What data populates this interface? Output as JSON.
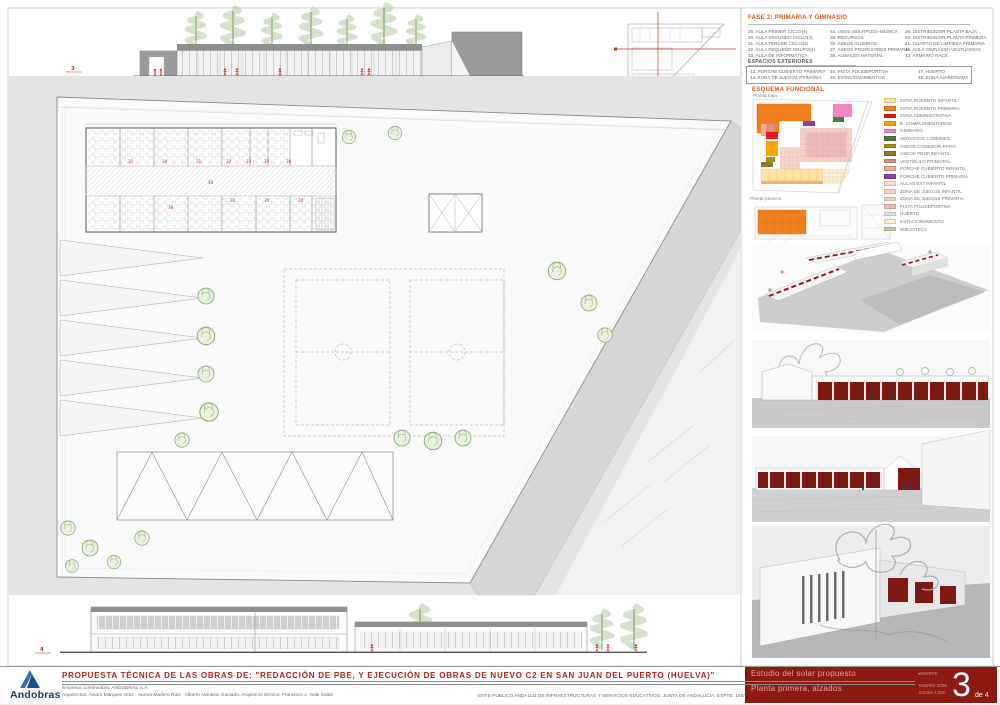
{
  "accent": {
    "orange_header": "#e2561c",
    "title_red": "#b3231a",
    "panel_dark_red": "#8b1a12",
    "figure_red": "#c0392b",
    "tree_green": "#85a468",
    "logo_blue": "#2f6db5",
    "logo_navy": "#1d4e8f"
  },
  "fase2": {
    "title": "FASE 2:   PRIMARIA Y GIMNASIO",
    "col1": [
      "29. AULA PRIMER CICLO(4)",
      "30. AULA SEGUNDO CICLO(4)",
      "31. AULA TERCER CICLO(4)",
      "32. AULA PEQUEÑO GRUPO(4)",
      "33. AULA DE INFORMÁTICA"
    ],
    "col2": [
      "34. USOS MÚLTIPLES+MÚSICA",
      "35. RECURSOS",
      "36. ASEOS ALUMNOS",
      "37. ASEOS PROFESORES PRIMARIA",
      "38. ALMACÉN MATERIAL"
    ],
    "col3": [
      "39. DISTRIBUIDOR PLANTA BAJA",
      "40. DISTRIBUIDOR PLANTA PRIMERA",
      "41. CUARTO DE LIMPIEZA PRIMARIA",
      "42. AULA GIMNASIO+VESTUARIOS",
      "43. ARMARIO RACK"
    ]
  },
  "exteriores": {
    "title": "ESPACIOS EXTERIORES",
    "col1": [
      "43. PORCHE CUBIERTO PRIMARIA",
      "44. ZONA DE JUEGOS PRIMARIA"
    ],
    "col2": [
      "45. PISTA POLIDEPORTIVA",
      "46. ESTACIONAMIENTOS"
    ],
    "col3": [
      "47. HUERTO",
      "48. ZONA AJARDINADA"
    ]
  },
  "esquema": {
    "title": "ESQUEMA FUNCIONAL",
    "planta_baja": "Planta baja",
    "planta_primera": "Planta primera"
  },
  "legend": {
    "items": [
      {
        "label": "ZONA DOCENTE INFANTIL",
        "color": "#fbe3a3"
      },
      {
        "label": "ZONA DOCENTE PRIMARIA",
        "color": "#f07f1e"
      },
      {
        "label": "ZONA ADMINISTRATIVA",
        "color": "#e51717"
      },
      {
        "label": "E. COMPLEMENTARIOS",
        "color": "#f6a800"
      },
      {
        "label": "GIMNASIO",
        "color": "#f287c3"
      },
      {
        "label": "SERVICIOS COMUNES",
        "color": "#4d7b3c"
      },
      {
        "label": "ASEOS COMEDOR-PATIO",
        "color": "#a39312"
      },
      {
        "label": "ASEOS PROF.INFANTIL",
        "color": "#877d22"
      },
      {
        "label": "VESTÍBULO PRINCIPAL",
        "color": "#dd9180"
      },
      {
        "label": "PORCHE CUBIERTO INFANTIL",
        "color": "#f4a98b"
      },
      {
        "label": "PORCHE CUBIERTO PRIMARIA",
        "color": "#8e3f9e"
      },
      {
        "label": "AULAS EXT.INFANTIL",
        "color": "#f6dcd4"
      },
      {
        "label": "ZONA DE JUEGOS INFANTIL",
        "color": "#f4d3cb"
      },
      {
        "label": "ZONA DE JUEGOS PRIMARIA",
        "color": "#f2cfc7"
      },
      {
        "label": "PISTA POLIDEPORTIVA",
        "color": "#eeb9bb"
      },
      {
        "label": "HUERTO",
        "color": "#d9ead0"
      },
      {
        "label": "ESTACIONAMIENTO",
        "color": "#f6efd2"
      },
      {
        "label": "BIBLIOTECA",
        "color": "#c2cda6"
      }
    ]
  },
  "plan": {
    "marker_top": "3",
    "marker_bottom": "4",
    "room_numbers": [
      "31",
      "30",
      "31",
      "32",
      "33",
      "35",
      "36",
      "40",
      "38",
      "30",
      "30",
      "30"
    ]
  },
  "titleblock": {
    "logo_text": "Andobras",
    "title": "PROPUESTA TÉCNICA DE LAS OBRAS DE: \"REDACCIÓN DE PBE, Y EJECUCIÓN DE OBRAS DE NUEVO C2 EN SAN JUAN DEL PUERTO (HUELVA)\"",
    "line1": "Empresa constructora: ANDOBRAS S.A.",
    "line2": "Arquitectos: Álvaro Márquez Ortiz - Aurora Madero Ruiz - Alberto Atanasio Guisado.    Arquitecto técnico: Francisco J. Valle Salas",
    "entity": "ENTE PÚBLICO ANDALUZ DE INFRAESTRUCTURAS Y SERVICIOS EDUCATIVOS.   JUNTA DE ANDALUCÍA.   EXPTE. 165/ISE/2008",
    "panel": {
      "row1": "Estudio del solar propuesto",
      "row2": "Planta primera, alzados",
      "north": "NORTE",
      "date": "ENERO 2009",
      "scale": "Escala 1:300",
      "sheet_number": "3",
      "sheet_total": "de 4"
    }
  }
}
